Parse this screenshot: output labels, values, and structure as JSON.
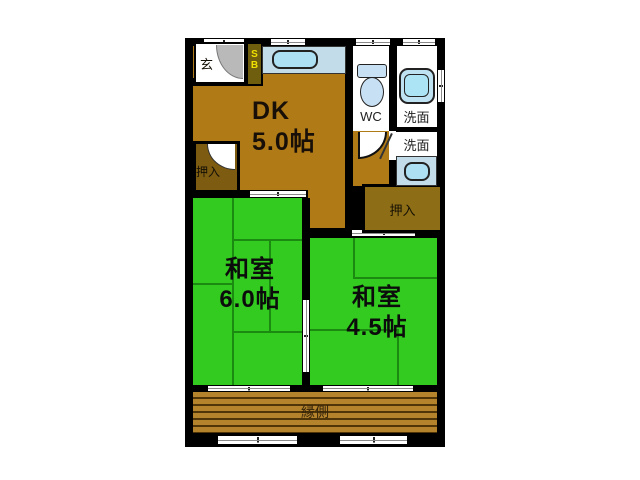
{
  "plan": {
    "dk": {
      "name": "DK",
      "size": "5.0帖"
    },
    "washitsu_6": {
      "name": "和室",
      "size": "6.0帖"
    },
    "washitsu_45": {
      "name": "和室",
      "size": "4.5帖"
    },
    "engawa": {
      "name": "縁側"
    },
    "wc": {
      "name": "WC"
    },
    "washroom_upper": {
      "name": "洗面"
    },
    "washroom_lower": {
      "name": "洗面"
    },
    "closet_left": {
      "name": "押入"
    },
    "closet_right": {
      "name": "押入"
    },
    "entrance": {
      "name": "玄"
    },
    "shoe_box": {
      "name": "S\nB"
    }
  },
  "colors": {
    "wall": "#000000",
    "dk_floor": "#b07a16",
    "tatami": "#33cb20",
    "tatami_line": "#1b8a10",
    "engawa_wood": "#b5832c",
    "closet_left_fill": "#7d5c12",
    "closet_right_fill": "#8d6e16",
    "fixture_blue": "#aee0f4",
    "counter_blue": "#c2dcea",
    "shoe_box_fill": "#6e5e0e",
    "shoe_box_text": "#f0e000"
  }
}
